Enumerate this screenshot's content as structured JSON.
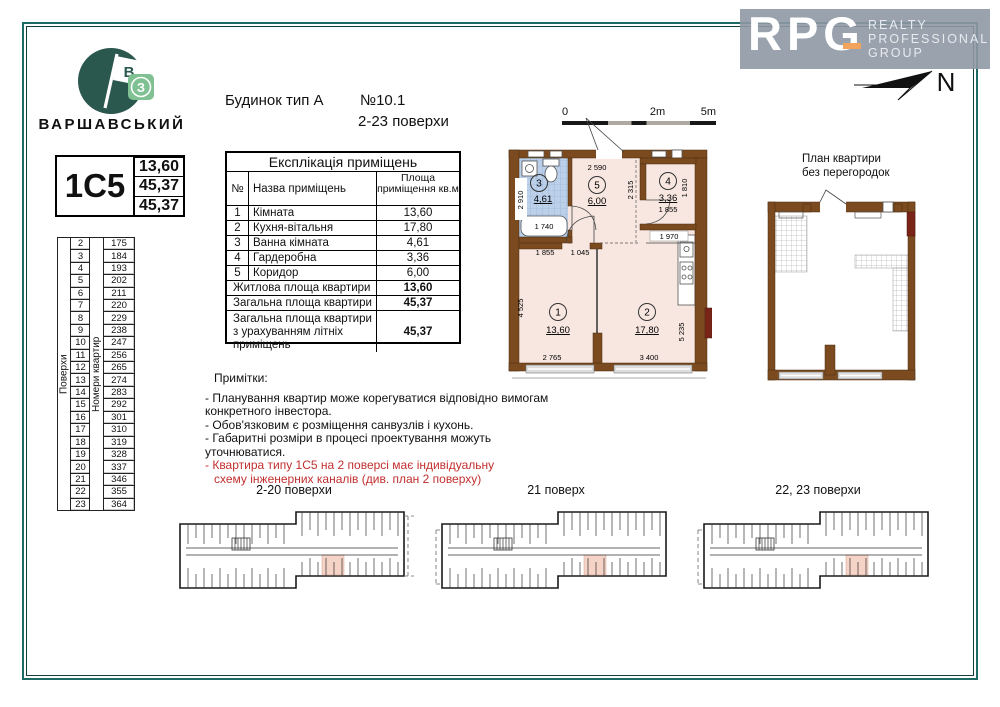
{
  "brand": {
    "name": "ВАРШАВСЬКИЙ",
    "flag_letter": "В",
    "badge_letter": "З"
  },
  "header": {
    "building": "Будинок тип А",
    "number": "№10.1",
    "floors": "2-23 поверхи"
  },
  "rpg": {
    "letters": "RPG",
    "words": [
      "REALTY",
      "PROFESSIONAL",
      "GROUP"
    ]
  },
  "compass": {
    "label": "N"
  },
  "apartment": {
    "code": "1С5",
    "values": [
      "13,60",
      "45,37",
      "45,37"
    ]
  },
  "floors_table": {
    "floors_label": "Поверхи",
    "numbers_label": "Номери квартир",
    "floors": [
      "2",
      "3",
      "4",
      "5",
      "6",
      "7",
      "8",
      "9",
      "10",
      "11",
      "12",
      "13",
      "14",
      "15",
      "16",
      "17",
      "18",
      "19",
      "20",
      "21",
      "22",
      "23"
    ],
    "numbers": [
      "175",
      "184",
      "193",
      "202",
      "211",
      "220",
      "229",
      "238",
      "247",
      "256",
      "265",
      "274",
      "283",
      "292",
      "301",
      "310",
      "319",
      "328",
      "337",
      "346",
      "355",
      "364"
    ]
  },
  "explication": {
    "title": "Експлікація приміщень",
    "col_num": "№",
    "col_name": "Назва приміщень",
    "col_area": "Площа приміщення кв.м",
    "rows": [
      {
        "num": "1",
        "name": "Кімната",
        "area": "13,60"
      },
      {
        "num": "2",
        "name": "Кухня-вітальня",
        "area": "17,80"
      },
      {
        "num": "3",
        "name": "Ванна кімната",
        "area": "4,61"
      },
      {
        "num": "4",
        "name": "Гардеробна",
        "area": "3,36"
      },
      {
        "num": "5",
        "name": "Коридор",
        "area": "6,00"
      }
    ],
    "totals": [
      {
        "name": "Житлова площа квартири",
        "area": "13,60"
      },
      {
        "name": "Загальна площа квартири",
        "area": "45,37"
      },
      {
        "name": "Загальна площа квартири з урахуванням літніх приміщень",
        "area": "45,37"
      }
    ]
  },
  "scale_bar": {
    "t0": "0",
    "t2": "2m",
    "t5": "5m"
  },
  "plan": {
    "room1_num": "1",
    "room1_area": "13,60",
    "room2_num": "2",
    "room2_area": "17,80",
    "room3_num": "3",
    "room3_area": "4,61",
    "room4_num": "4",
    "room4_area": "3,36",
    "room5_num": "5",
    "room5_area": "6,00",
    "dims": {
      "top": "2 590",
      "corridor_h": "2 315",
      "bath_left": "2 910",
      "bath_tub": "1 740",
      "ward_w": "1 855",
      "ward_h": "1 810",
      "kitchen_top": "1 970",
      "room1_top_a": "1 855",
      "room1_top_b": "1 045",
      "room1_left": "4 525",
      "room1_bottom": "2 765",
      "room2_bottom": "3 400",
      "room2_right": "5 235"
    }
  },
  "right_plan": {
    "title1": "План квартири",
    "title2": "без перегородок"
  },
  "notes": {
    "title": "Примітки:",
    "items": [
      "- Планування квартир може корегуватися відповідно вимогам конкретного інвестора.",
      "- Обов'язковим є розміщення санвузлів і кухонь.",
      "- Габаритні розміри в процесі проектування можуть уточнюватися."
    ],
    "red_lines": [
      "- Квартира типу 1С5 на 2 поверсі має індивідуальну",
      "схему інженерних каналів (див. план 2 поверху)"
    ]
  },
  "key_plans": [
    {
      "label": "2-20 поверхи"
    },
    {
      "label": "21 поверх"
    },
    {
      "label": "22, 23 поверхи"
    }
  ],
  "colors": {
    "frame": "#1d6b63",
    "wall": "#7b4a1f",
    "room": "#f8e7e1",
    "bath": "#bcd0ea",
    "redwall": "#7a2418",
    "accent": "#f2a35c",
    "rednote": "#c22f2f",
    "hl": "#f5d3c6"
  }
}
